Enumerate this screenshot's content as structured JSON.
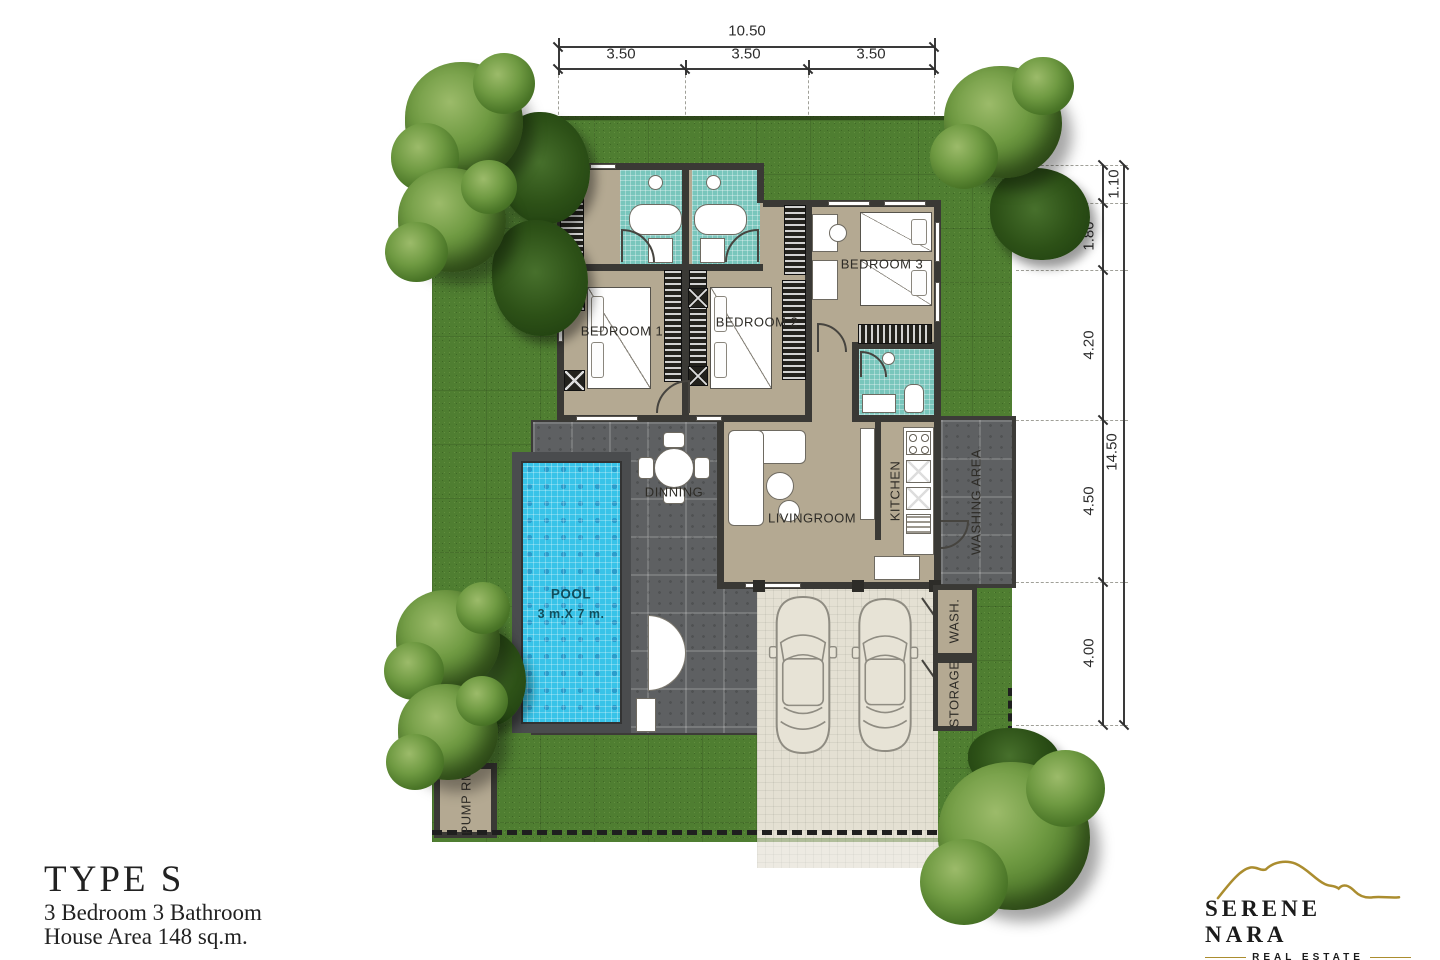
{
  "title_block": {
    "type": "TYPE S",
    "line1": "3 Bedroom 3 Bathroom",
    "line2": "House Area 148 sq.m."
  },
  "logo": {
    "name": "SERENE NARA",
    "tagline": "REAL ESTATE"
  },
  "rooms": {
    "bedroom1": "BEDROOM 1",
    "bedroom2": "BEDROOM 2",
    "bedroom3": "BEDROOM 3",
    "dining": "DINNING",
    "living": "LIVINGROOM",
    "kitchen": "KITCHEN",
    "washing_area": "WASHING AREA",
    "wash": "WASH.",
    "storage": "STORAGE",
    "pump_room": "PUMP RM.",
    "pool": "POOL",
    "pool_size": "3 m.X 7 m."
  },
  "dimensions": {
    "top_total": "10.50",
    "top_segments": [
      "3.50",
      "3.50",
      "3.50"
    ],
    "right_segments": [
      "1.10",
      "1.80",
      "4.20",
      "4.50",
      "4.00"
    ],
    "right_total": "14.50",
    "bottom_car_segments": [
      "2.80",
      "2.20"
    ],
    "bottom_lower_segments": [
      "3.00",
      "5.00"
    ]
  },
  "colors": {
    "grass": "#4f7e31",
    "pool": "#38c3e8",
    "bath_tile": "#79c6bc",
    "floor": "#b4a992",
    "wall": "#3a3935",
    "deck": "#5e6062",
    "driveway": "#e4e0d3",
    "logo_gold": "#ab8d2f"
  }
}
